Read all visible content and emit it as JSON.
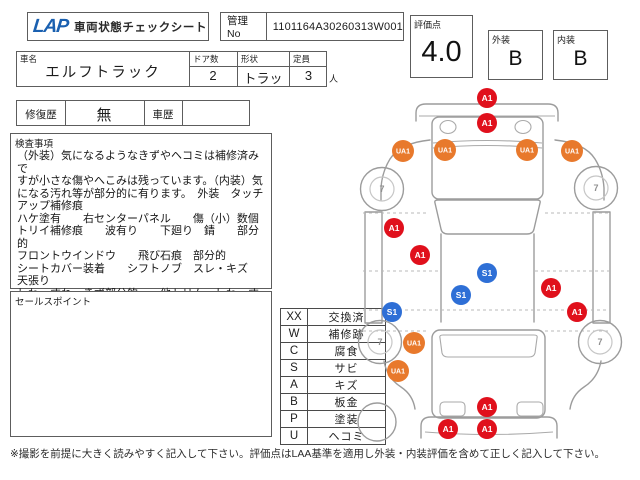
{
  "header": {
    "logo": "LAP",
    "title": "車両状態チェックシート",
    "mgmt_label": "管理No",
    "mgmt_no": "1101164A30260313W001",
    "score_label": "評価点",
    "score": "4.0",
    "exterior_label": "外装",
    "exterior_grade": "B",
    "interior_label": "内装",
    "interior_grade": "B"
  },
  "vehicle": {
    "name_label": "車名",
    "name": "エルフトラック",
    "doors_label": "ドア数",
    "doors": "2",
    "shape_label": "形状",
    "shape": "トラッ",
    "capacity_label": "定員",
    "capacity": "3",
    "capacity_unit": "人"
  },
  "history": {
    "repair_label": "修復歴",
    "repair_value": "無",
    "history_label": "車歴",
    "history_value": ""
  },
  "inspection": {
    "label": "検査事項",
    "text": "（外装）気になるようなきずやヘコミは補修済みで\nすが小さな傷やへこみは残っています。（内装）気\nになる汚れ等が部分的に有ります。　外装　タッチ\nアップ補修痕\nハケ塗有　　右センターパネル　　傷（小）数個\nトリイ補修痕　　波有り　　下廻り　錆　　部分的\nフロントウインドウ　　飛び石痕　部分的\nシートカバー装着　　シフトノブ　スレ・キズ\n天張り\nしわ・すれ・きず部分的　　他トリム　しわ・すれ\n・きず"
  },
  "sales": {
    "label": "セールスポイント",
    "text": ""
  },
  "legend": {
    "rows": [
      {
        "code": "XX",
        "label": "交換済"
      },
      {
        "code": "W",
        "label": "補修跡"
      },
      {
        "code": "C",
        "label": "腐食"
      },
      {
        "code": "S",
        "label": "サビ"
      },
      {
        "code": "A",
        "label": "キズ"
      },
      {
        "code": "B",
        "label": "板金"
      },
      {
        "code": "P",
        "label": "塗装"
      },
      {
        "code": "U",
        "label": "ヘコミ"
      }
    ]
  },
  "footer": {
    "note": "※撮影を前提に大きく読みやすく記入して下さい。評価点はLAA基準を適用し外装・内装評価を含めて正しく記入して下さい。"
  },
  "diagram": {
    "wheel_label": "7",
    "colors": {
      "A": "#e0101c",
      "U": "#e8792c",
      "S": "#2e6fd6"
    },
    "wheels": [
      {
        "x": 27,
        "y": 104
      },
      {
        "x": 241,
        "y": 103
      },
      {
        "x": 25,
        "y": 257
      },
      {
        "x": 245,
        "y": 257
      }
    ],
    "markers": [
      {
        "label": "A1",
        "x": 132,
        "y": 13
      },
      {
        "label": "A1",
        "x": 132,
        "y": 38
      },
      {
        "label": "UA1",
        "x": 48,
        "y": 66
      },
      {
        "label": "UA1",
        "x": 90,
        "y": 65
      },
      {
        "label": "UA1",
        "x": 172,
        "y": 65
      },
      {
        "label": "UA1",
        "x": 217,
        "y": 66
      },
      {
        "label": "A1",
        "x": 39,
        "y": 143
      },
      {
        "label": "A1",
        "x": 65,
        "y": 170
      },
      {
        "label": "S1",
        "x": 132,
        "y": 188
      },
      {
        "label": "S1",
        "x": 106,
        "y": 210
      },
      {
        "label": "A1",
        "x": 196,
        "y": 203
      },
      {
        "label": "A1",
        "x": 222,
        "y": 227
      },
      {
        "label": "S1",
        "x": 37,
        "y": 227
      },
      {
        "label": "UA1",
        "x": 59,
        "y": 258
      },
      {
        "label": "UA1",
        "x": 43,
        "y": 286
      },
      {
        "label": "A1",
        "x": 132,
        "y": 322
      },
      {
        "label": "A1",
        "x": 93,
        "y": 344
      },
      {
        "label": "A1",
        "x": 132,
        "y": 344
      }
    ]
  }
}
